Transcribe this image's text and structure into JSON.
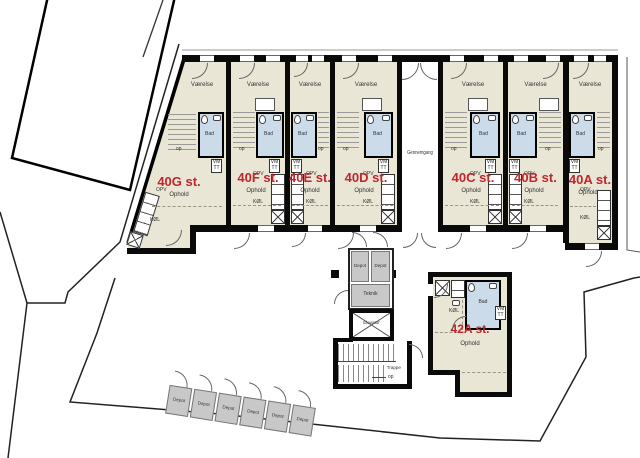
{
  "units": [
    {
      "id": "40G",
      "name": "40G st."
    },
    {
      "id": "40F",
      "name": "40F st."
    },
    {
      "id": "40E",
      "name": "40E st."
    },
    {
      "id": "40D",
      "name": "40D st."
    },
    {
      "id": "40C",
      "name": "40C st."
    },
    {
      "id": "40B",
      "name": "40B st."
    },
    {
      "id": "40A",
      "name": "40A st."
    }
  ],
  "unit42": {
    "name": "42A st."
  },
  "labels": {
    "room": "Værelse",
    "living": "Ophold",
    "bath": "Bad",
    "dishwasher": "OPV",
    "fridge": "KØL",
    "washer": "VM",
    "dryer": "TT",
    "up": "op",
    "passage": "Gennemgang",
    "storage": "Depot",
    "technical": "Teknik",
    "elevator": "Elevator",
    "stairs": "Trappe"
  },
  "sheds": [
    "Depot",
    "Depot",
    "Depot",
    "Depot",
    "Depot",
    "Depot"
  ],
  "colors": {
    "floor": "#e9e6d5",
    "bath": "#cbdbe9",
    "storage": "#c8c8c8",
    "wall": "#0a0a0a",
    "red": "#c0262c",
    "line": "#555555"
  }
}
